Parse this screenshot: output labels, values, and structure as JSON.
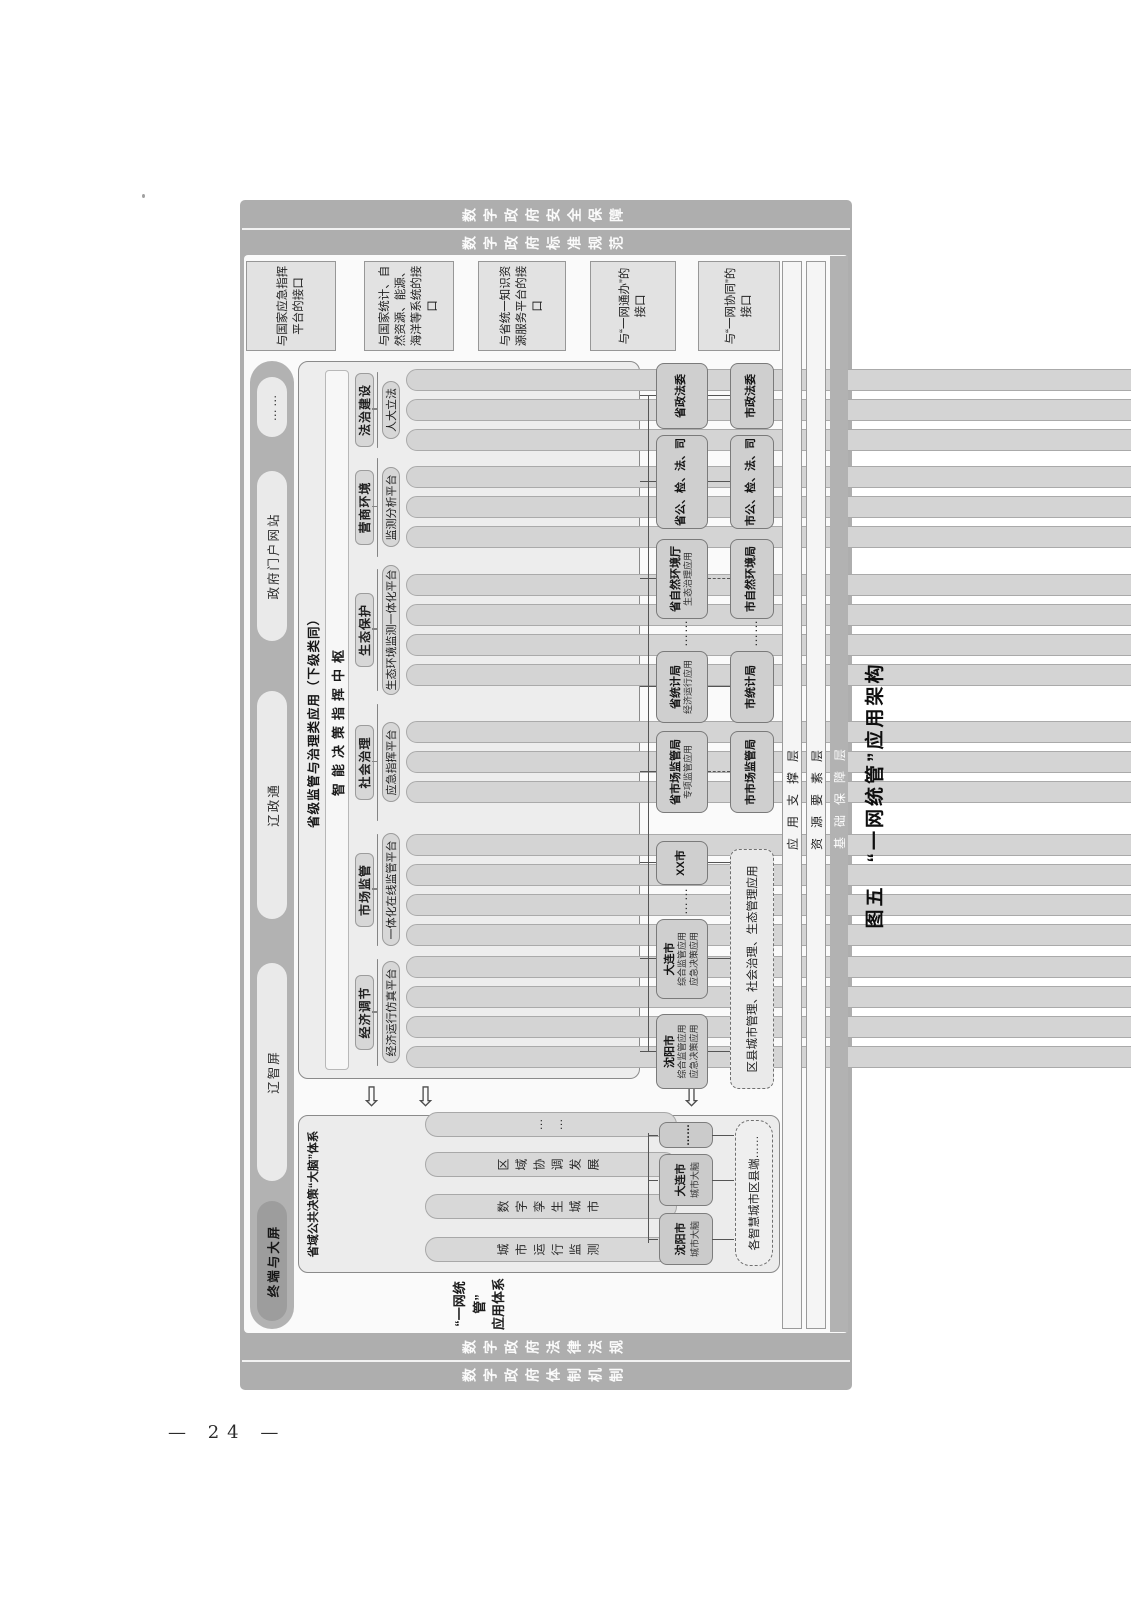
{
  "page_number": "—  24  —",
  "caption": "图五　“一网统管”应用架构",
  "colors": {
    "frame_gray": "#aeaeae",
    "panel_white": "#fafafa",
    "box_gray": "#ededed",
    "bar_gray": "#d4d4d4"
  },
  "pillars": {
    "left_outer": "数字政府体制机制",
    "left_inner": "数字政府法律法规",
    "right_inner": "数字政府标准规范",
    "right_outer": "数字政府安全保障"
  },
  "layers": {
    "app_support": "应用支撑层",
    "data_elements": "资源要素层",
    "base_support": "基础保障层"
  },
  "terminals": {
    "label": "终端与大屏",
    "items": [
      "辽智屏",
      "辽政通",
      "政府门户网站",
      "……"
    ]
  },
  "interfaces": [
    "与国家应急指挥平台的接口",
    "与国家统计、自然资源、能源、海洋等系统的接口",
    "与省统一知识资源服务平台的接口",
    "与“一网通办”的接口",
    "与“一网协同”的接口"
  ],
  "system_label": {
    "line1": "“一网统管”",
    "line2": "应用体系"
  },
  "brain": {
    "title": "省域公共决策“大脑”体系",
    "pills": [
      "城市运行监测",
      "数字孪生城市",
      "区域协调发展",
      "……"
    ],
    "city_brains": [
      {
        "name": "沈阳市",
        "sub": "城市大脑"
      },
      {
        "name": "大连市",
        "sub": "城市大脑"
      },
      {
        "name": "……",
        "sub": ""
      }
    ],
    "dashed": "各智慧城市区县端……"
  },
  "main": {
    "title": "省级监管与治理类应用（下级类同）",
    "hub": "智能决策指挥中枢",
    "sections": [
      {
        "label": "经济调节",
        "platform": "经济运行仿真平台",
        "bars": [
          "产业链分析",
          "金融风险监测预警",
          "经济运行态势",
          "……"
        ]
      },
      {
        "label": "市场监管",
        "platform": "一体化在线监管平台",
        "bars": [
          "食品安全",
          "药品智慧监管",
          "智慧能源综合监管",
          "……"
        ]
      },
      {
        "label": "社会治理",
        "platform": "应急指挥平台",
        "bars": [
          "智慧警务",
          "疫情防控管理",
          "……"
        ]
      },
      {
        "label": "生态保护",
        "platform": "生态环境监测一体化平台",
        "bars": [
          "自然资源一张图",
          "智慧海洋大数据",
          "智慧水利公共管理",
          "……"
        ]
      },
      {
        "label": "营商环境",
        "platform": "监测分析平台",
        "bars": [
          "营商环境评价",
          "信用辽宁",
          "……"
        ]
      },
      {
        "label": "法治建设",
        "platform": "人大立法",
        "bars": [
          "政法一体化",
          "公、检、法、司",
          "……"
        ]
      }
    ]
  },
  "row1": [
    {
      "name": "沈阳市",
      "subs": [
        "综合监管应用",
        "应急决策应用"
      ]
    },
    {
      "name": "大连市",
      "subs": [
        "综合监管应用",
        "应急决策应用"
      ]
    },
    {
      "name": "……",
      "subs": []
    },
    {
      "name": "XX市",
      "subs": []
    },
    {
      "name": "省市场监管局",
      "subs": [
        "专项监管应用"
      ]
    },
    {
      "name": "省统计局",
      "subs": [
        "经济运行应用"
      ]
    },
    {
      "name": "……",
      "subs": []
    },
    {
      "name": "省自然环境厅",
      "subs": [
        "生态治理应用"
      ]
    },
    {
      "name": "省公、检、法、司",
      "subs": []
    },
    {
      "name": "省政法委",
      "subs": []
    }
  ],
  "row2": {
    "dashed": "区县城市管理、社会治理、生态管理应用",
    "boxes": [
      "市市场监管局",
      "市统计局",
      "……",
      "市自然环境局",
      "市公、检、法、司",
      "市政法委"
    ]
  }
}
